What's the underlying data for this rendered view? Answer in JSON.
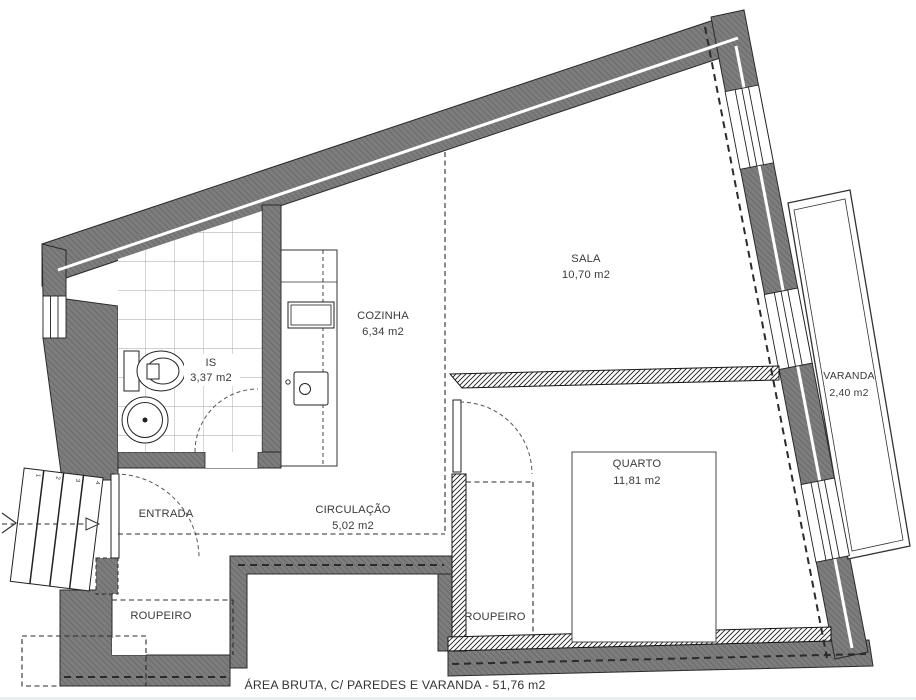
{
  "plan": {
    "caption": "ÁREA BRUTA, C/ PAREDES E VARANDA - 51,76 m2"
  },
  "rooms": {
    "sala": {
      "name": "SALA",
      "area": "10,70 m2"
    },
    "cozinha": {
      "name": "COZINHA",
      "area": "6,34 m2"
    },
    "is": {
      "name": "IS",
      "area": "3,37 m2"
    },
    "varanda": {
      "name": "VARANDA",
      "area": "2,40 m2"
    },
    "quarto": {
      "name": "QUARTO",
      "area": "11,81 m2"
    },
    "entrada": {
      "name": "ENTRADA"
    },
    "circulacao": {
      "name": "CIRCULAÇÃO",
      "area": "5,02 m2"
    },
    "roupeiro_hall": {
      "name": "ROUPEIRO"
    },
    "roupeiro_quarto": {
      "name": "ROUPEIRO"
    }
  },
  "stairs": {
    "step_numbers": [
      "1",
      "2",
      "3",
      "4"
    ]
  },
  "colors": {
    "wall_gray": "#7d7d7d",
    "wall_hatch_line": "#6b6b6b",
    "wall_outline": "#2a2a2a",
    "new_wall_hatch": "#1c1c1c",
    "tile_line": "#a3a3a3",
    "text": "#3a3a3a",
    "background": "#ffffff"
  }
}
